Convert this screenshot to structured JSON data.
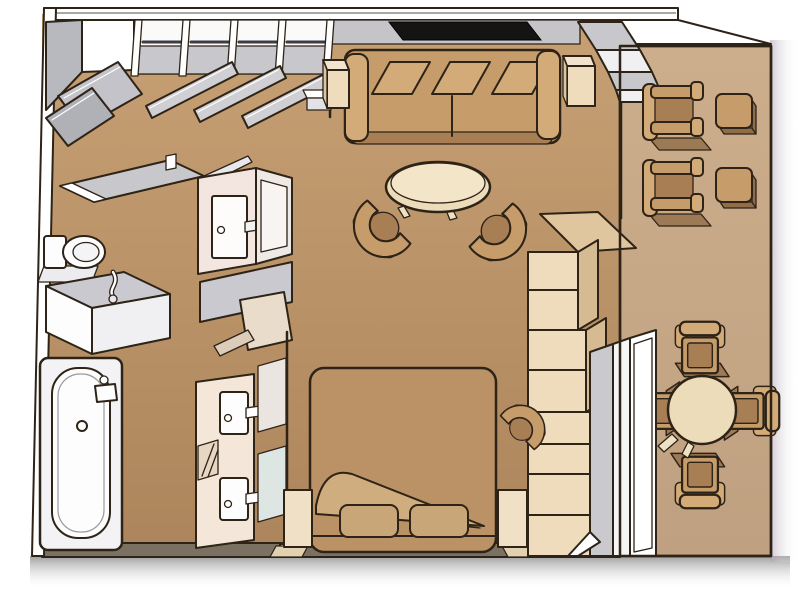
{
  "meta": {
    "title": "Suite stateroom floor plan",
    "view": "isometric cutaway floor plan",
    "visible_text": ""
  },
  "colors": {
    "outline": "#2e2317",
    "pageBg": "#ffffff",
    "floorTop": "#c7a074",
    "floorBottom": "#ad855c",
    "balconyTop": "#ccae8c",
    "balconyBottom": "#bfa080",
    "wallWhite": "#ffffff",
    "wallGray": "#c7c7cc",
    "wallFaceGray": "#c4c4c9",
    "closetGray": "#c3c3c9",
    "closetGrayDark": "#b0b0b7",
    "bottomWall": "#7b7163",
    "tv": "#141414",
    "wood": "#c69d6a",
    "woodLight": "#d2ab79",
    "woodDark": "#8f6d48",
    "seatDark": "#a87f54",
    "woodShadow": "#9c7a55",
    "bedCover": "#ba9265",
    "sheetFold": "#cfad7e",
    "pillow": "#c9a678",
    "cream": "#eedcbc",
    "creamLight": "#f4e7da",
    "creamSide": "#d5ba92",
    "creamTop": "#e0c69e",
    "tableTop": "#ecdcba",
    "fixtureWhite": "#fdfdfe",
    "counterGray": "#c9c9cf",
    "mirrorBlue": "#dde6e2",
    "mirrorPink": "#f3e6e0",
    "shadowBottom": "#8b8b8b",
    "shadowRight": "#b3a4b5"
  },
  "rooms": {
    "bathroom": {
      "label": "Bathroom with bathtub, shower, toilet and washbasin"
    },
    "dressing": {
      "label": "Dressing area with wardrobes and double-sink vanity"
    },
    "living": {
      "label": "Living area with sofa, TV and coffee table"
    },
    "bedroom": {
      "label": "Bedroom with queen bed"
    },
    "balcony": {
      "label": "Private balcony with loungers and dining table"
    }
  },
  "items": {
    "corner_wardrobe": {
      "label": "Corner wardrobe with open doors"
    },
    "wardrobe": {
      "label": "Wardrobe run of four bays with hanging rails and open doors"
    },
    "tv": {
      "label": "Wall-mounted flat-screen TV"
    },
    "threshold_steps": {
      "label": "Stepped balcony-door threshold"
    },
    "sofa": {
      "label": "Three-cushion sofa"
    },
    "side_table_left": {
      "label": "Side table left of sofa"
    },
    "side_table_right": {
      "label": "Side table right of sofa"
    },
    "coffee_table": {
      "label": "Oval coffee table"
    },
    "tub_chair_left": {
      "label": "Barrel lounge chair"
    },
    "tub_chair_right": {
      "label": "Barrel lounge chair"
    },
    "shower": {
      "label": "Shower with hinged glass door"
    },
    "toilet": {
      "label": "Toilet"
    },
    "washbasin": {
      "label": "Washbasin counter with gooseneck faucet"
    },
    "bathtub": {
      "label": "Bathtub with faucet and drain"
    },
    "wc_room": {
      "label": "Enclosed WC with door, mirror and counter"
    },
    "wc_open_door": {
      "label": "Open door panel"
    },
    "vanity": {
      "label": "Double-sink vanity with two mirrors"
    },
    "vanity_door": {
      "label": "Dressing-area door swing"
    },
    "partition": {
      "label": "Partition wall between dressing area and bedroom"
    },
    "bed": {
      "label": "Queen bed with turned-down sheet and two pillows"
    },
    "nightstand_left": {
      "label": "Nightstand left of bed"
    },
    "nightstand_right": {
      "label": "Nightstand right of bed"
    },
    "desk_chair": {
      "label": "Vanity chair beside cabinet"
    },
    "tall_cabinet": {
      "label": "Tall cabinet and wardrobe unit"
    },
    "balcony_window": {
      "label": "Floor-to-ceiling window with sliding door"
    },
    "lounger_1": {
      "label": "Balcony lounge chair"
    },
    "lounger_2": {
      "label": "Balcony lounge chair"
    },
    "balcony_table_1": {
      "label": "Balcony side table"
    },
    "balcony_table_2": {
      "label": "Balcony side table"
    },
    "dining_table": {
      "label": "Round dining table"
    },
    "dining_chair_top": {
      "label": "Dining chair"
    },
    "dining_chair_right": {
      "label": "Dining chair"
    },
    "dining_chair_bottom": {
      "label": "Dining chair"
    },
    "dining_chair_left": {
      "label": "Dining chair"
    }
  }
}
